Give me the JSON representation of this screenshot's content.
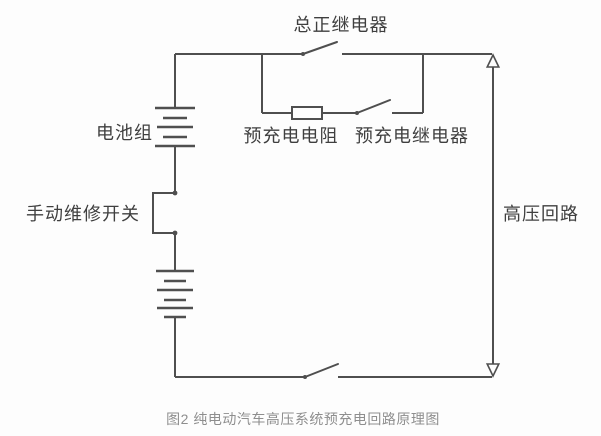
{
  "figure": {
    "caption": "图2 纯电动汽车高压系统预充电回路原理图"
  },
  "circuit": {
    "labels": {
      "main_positive_relay": "总正继电器",
      "battery_pack": "电池组",
      "precharge_resistor": "预充电电阻",
      "precharge_relay": "预充电继电器",
      "manual_service_switch": "手动维修开关",
      "high_voltage_loop": "高压回路"
    },
    "components": {
      "main_positive_relay": "open switch on top wire",
      "precharge_branch": "resistor in series with open switch, parallel to main positive relay",
      "battery_pack": "two battery cell symbols in series",
      "manual_service_switch": "rectangular detour between two junction dots",
      "bottom_switch": "open switch on bottom wire",
      "high_voltage_loop": "vertical double-headed arrow on right side"
    }
  },
  "colors": {
    "wire": "#4f4f4f",
    "label_text": "#3f3f3f",
    "caption_text": "#8e8e8e",
    "background": "#fdfdfd"
  }
}
